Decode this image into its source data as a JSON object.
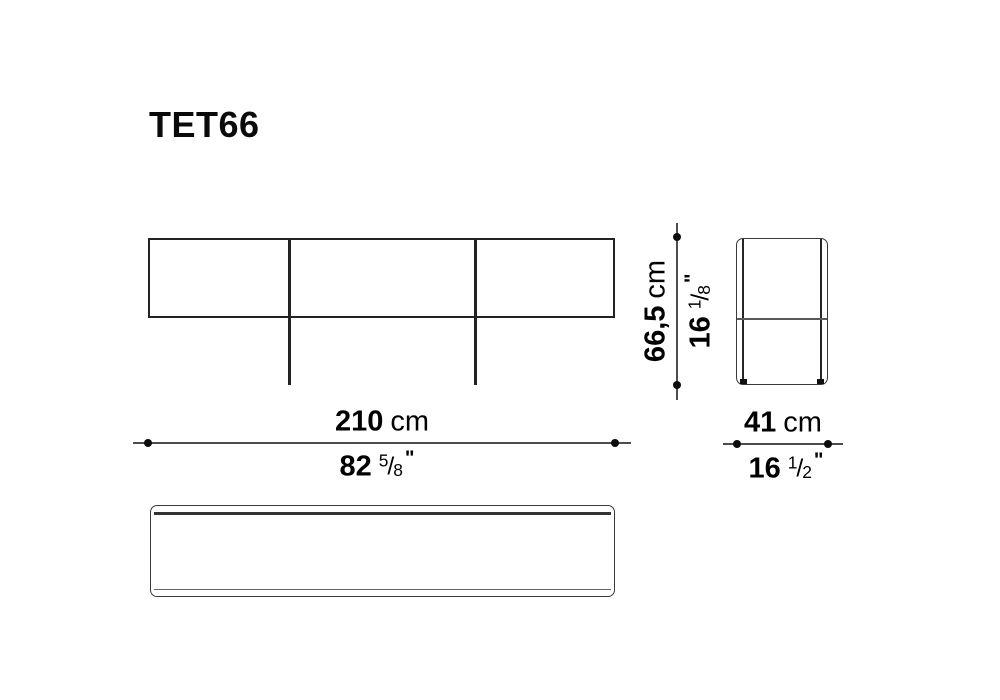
{
  "title": "TET66",
  "glyphs": {
    "fraction_slash": "/"
  },
  "dimensions": {
    "width": {
      "metric_value": "210",
      "metric_unit": "cm",
      "imperial_whole": "82",
      "imperial_num": "5",
      "imperial_den": "8",
      "imperial_unit": "\""
    },
    "height": {
      "metric_value": "66,5",
      "metric_unit": "cm",
      "imperial_whole": "16",
      "imperial_num": "1",
      "imperial_den": "8",
      "imperial_unit": "\""
    },
    "depth": {
      "metric_value": "41",
      "metric_unit": "cm",
      "imperial_whole": "16",
      "imperial_num": "1",
      "imperial_den": "2",
      "imperial_unit": "\""
    }
  },
  "colors": {
    "background": "#ffffff",
    "drawing_line": "#232323",
    "dimension_line": "#4d4d4d",
    "text": "#000000"
  }
}
